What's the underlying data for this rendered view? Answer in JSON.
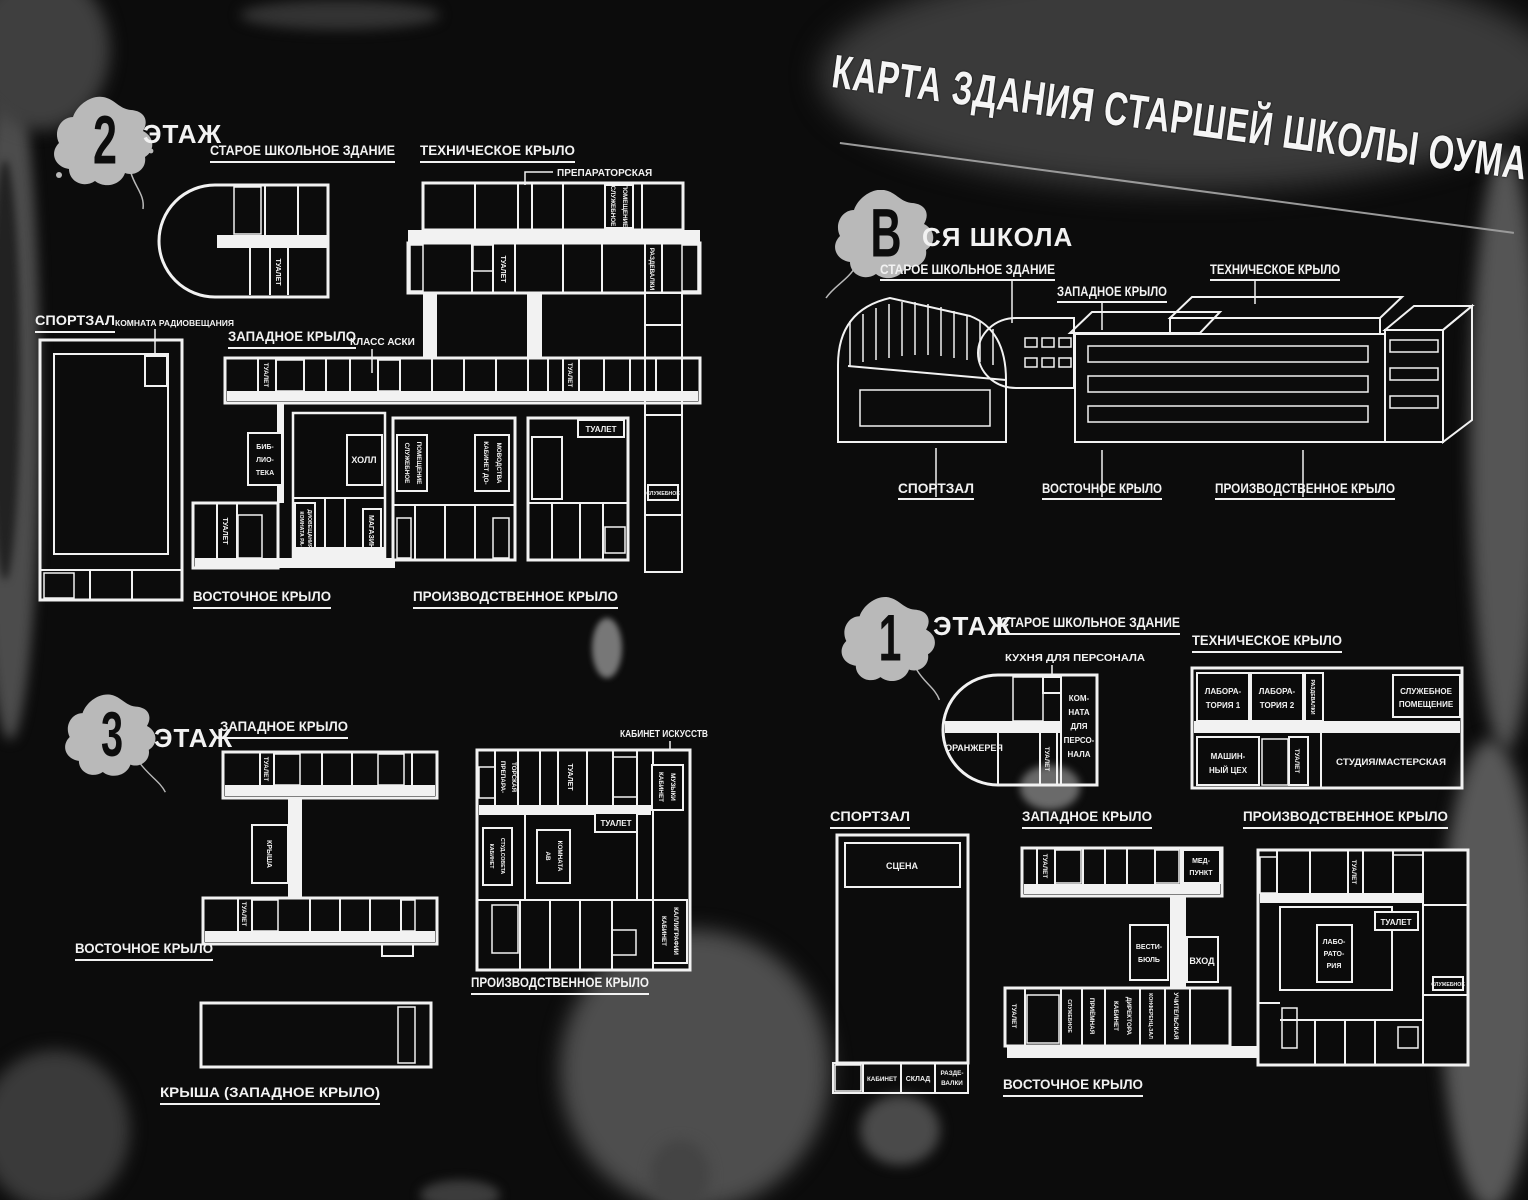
{
  "title": "КАРТА ЗДАНИЯ СТАРШЕЙ ШКОЛЫ ОУМА",
  "colors": {
    "background": "#0c0c0c",
    "plan_lines": "#f2f2f2",
    "splat": "#b9b9b9",
    "grunge": "#4a4a4a"
  },
  "common": {
    "floor_word": "ЭТАЖ",
    "toilet": "ТУАЛЕТ",
    "old_building": "СТАРОЕ ШКОЛЬНОЕ ЗДАНИЕ",
    "tech_wing": "ТЕХНИЧЕСКОЕ КРЫЛО",
    "west_wing": "ЗАПАДНОЕ КРЫЛО",
    "east_wing": "ВОСТОЧНОЕ КРЫЛО",
    "prod_wing": "ПРОИЗВОДСТВЕННОЕ КРЫЛО",
    "gym": "СПОРТЗАЛ",
    "lockers": "РАЗДЕВАЛКИ",
    "service": "СЛУЖЕБНОЕ",
    "service_lines": [
      "СЛУЖЕБНОЕ",
      "ПОМЕЩЕНИЕ"
    ]
  },
  "floor2": {
    "number": "2",
    "callouts": {
      "preparatory": "ПРЕПАРАТОРСКАЯ",
      "radio_room": "КОМНАТА РАДИОВЕЩАНИЯ",
      "aski_class": "КЛАСС АСКИ"
    },
    "rooms": {
      "library_lines": [
        "БИБ-",
        "ЛИО-",
        "ТЕКА"
      ],
      "hall": "ХОЛЛ",
      "radio_lines": [
        "КОМНАТА РА-",
        "ДИОВЕЩАНИЯ"
      ],
      "store": "МАГАЗИН",
      "home_econ_lines": [
        "КАБИНЕТ ДО-",
        "МОВОДСТВА"
      ]
    }
  },
  "whole_school": {
    "number": "В",
    "label": "СЯ ШКОЛА"
  },
  "floor3": {
    "number": "3",
    "callouts": {
      "art_room": "КАБИНЕТ ИСКУССТВ"
    },
    "headings": {
      "roof_west": "КРЫША (ЗАПАДНОЕ КРЫЛО)"
    },
    "rooms": {
      "roof": "КРЫША",
      "prep_lines": [
        "ПРЕПАРА-",
        "ТОРСКАЯ"
      ],
      "music_lines": [
        "КАБИНЕТ",
        "МУЗЫКИ"
      ],
      "council_lines": [
        "КАБИНЕТ",
        "СТУД.СОВЕТА"
      ],
      "av_lines": [
        "АВ",
        "КОМНАТА"
      ],
      "calligraphy_lines": [
        "КАБИНЕТ",
        "КАЛЛИГРАФИИ"
      ]
    }
  },
  "floor1": {
    "number": "1",
    "callouts": {
      "staff_kitchen": "КУХНЯ ДЛЯ ПЕРСОНАЛА"
    },
    "rooms": {
      "orangery": "ОРАНЖЕРЕЯ",
      "staff_lines": [
        "КОМ-",
        "НАТА",
        "ДЛЯ",
        "ПЕРСО-",
        "НАЛА"
      ],
      "lab1_lines": [
        "ЛАБОРА-",
        "ТОРИЯ 1"
      ],
      "lab2_lines": [
        "ЛАБОРА-",
        "ТОРИЯ 2"
      ],
      "machine_lines": [
        "МАШИН-",
        "НЫЙ ЦЕХ"
      ],
      "studio": "СТУДИЯ/МАСТЕРСКАЯ",
      "stage": "СЦЕНА",
      "office": "КАБИНЕТ",
      "storage": "СКЛАД",
      "changing_lines": [
        "РАЗДЕ-",
        "ВАЛКИ"
      ],
      "med_lines": [
        "МЕД-",
        "ПУНКТ"
      ],
      "lobby_lines": [
        "ВЕСТИ-",
        "БЮЛЬ"
      ],
      "entrance": "ВХОД",
      "reception": "ПРИЁМНАЯ",
      "principal_lines": [
        "КАБИНЕТ",
        "ДИРЕКТОРА"
      ],
      "conference": "КОНФЕРЕНЦ-ЗАЛ",
      "teachers": "УЧИТЕЛЬСКАЯ",
      "lab_lines": [
        "ЛАБО-",
        "РАТО-",
        "РИЯ"
      ]
    }
  }
}
